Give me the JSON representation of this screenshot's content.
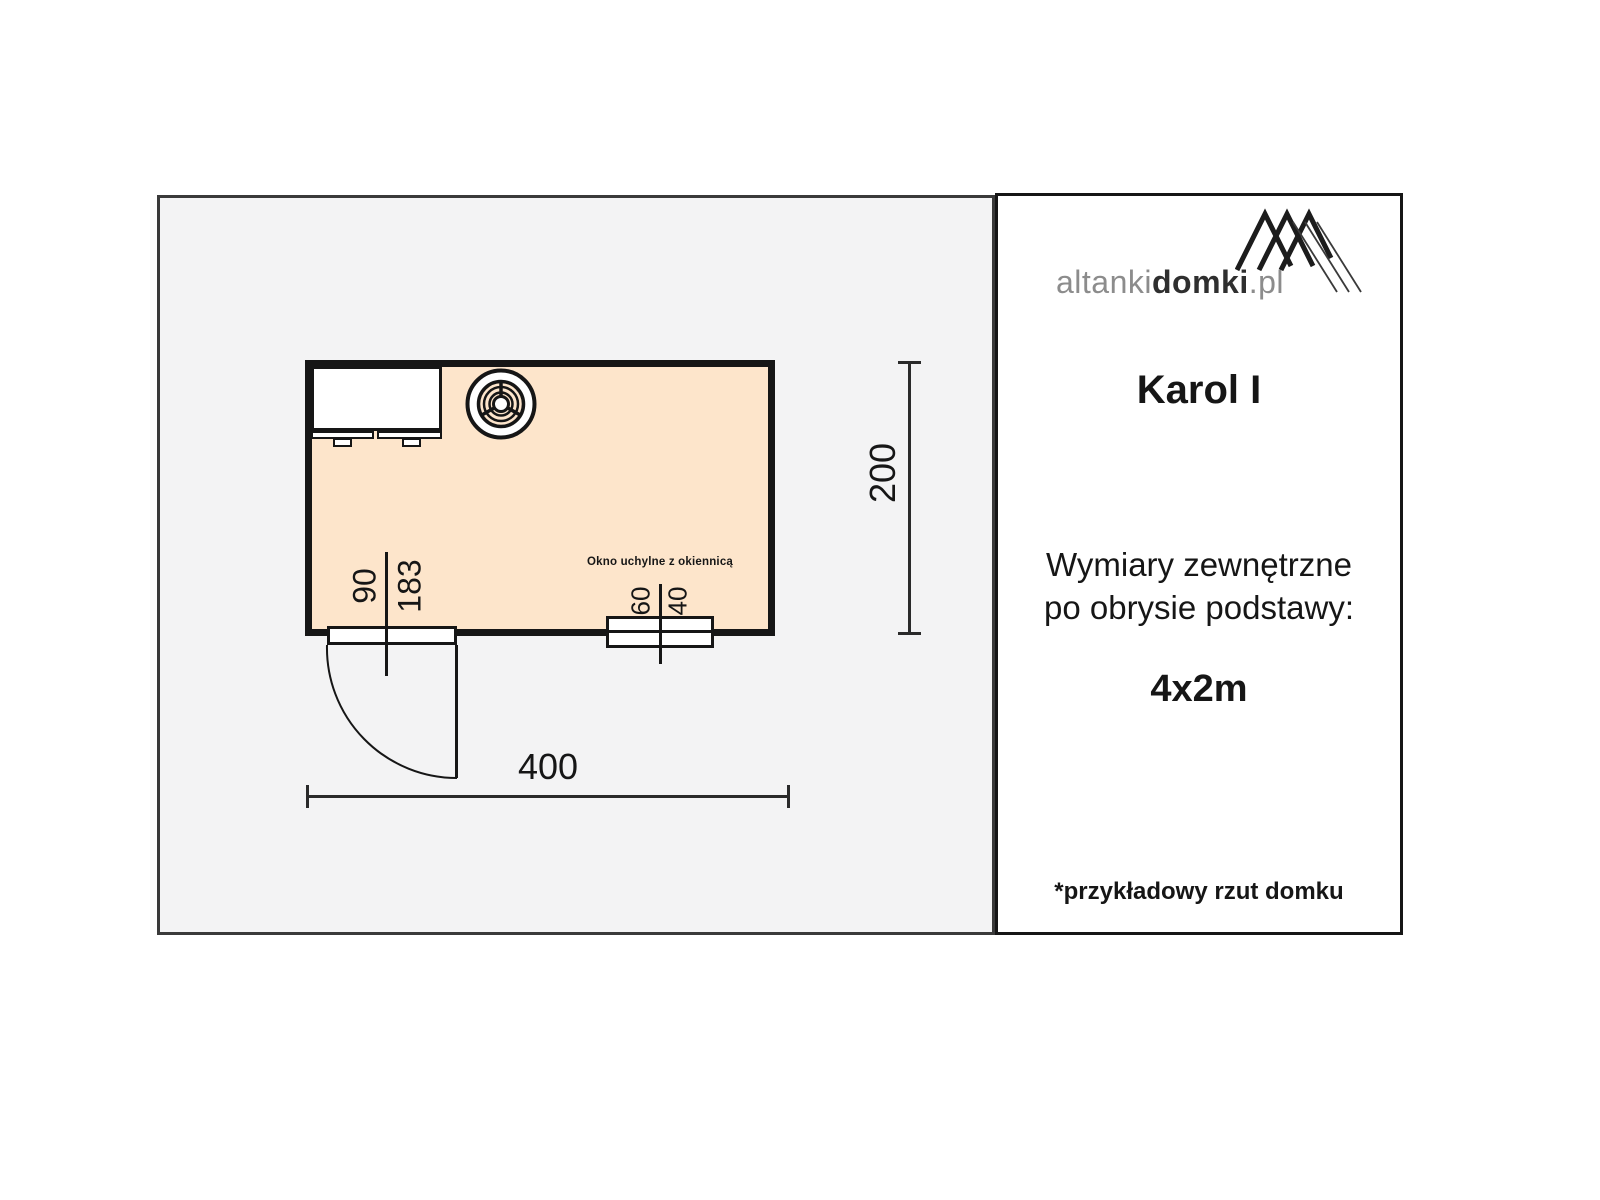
{
  "plan": {
    "window_caption": "Okno uchylne z okiennicą",
    "dimensions": {
      "overall_width": "400",
      "overall_depth": "200",
      "door_width": "90",
      "door_height": "183",
      "window_width": "60",
      "window_height": "40"
    }
  },
  "sidebar": {
    "logo": {
      "gray_prefix": "altanki",
      "bold": "domki",
      "suffix": ".pl"
    },
    "title": "Karol I",
    "subtitle": {
      "line1": "Wymiary zewnętrzne",
      "line2": "po obrysie podstawy:"
    },
    "size_label": "4x2m",
    "footnote": "*przykładowy rzut domku"
  },
  "colors": {
    "floor_fill": "#fde5cb",
    "site_background": "#f3f3f4",
    "line": "#161616"
  }
}
